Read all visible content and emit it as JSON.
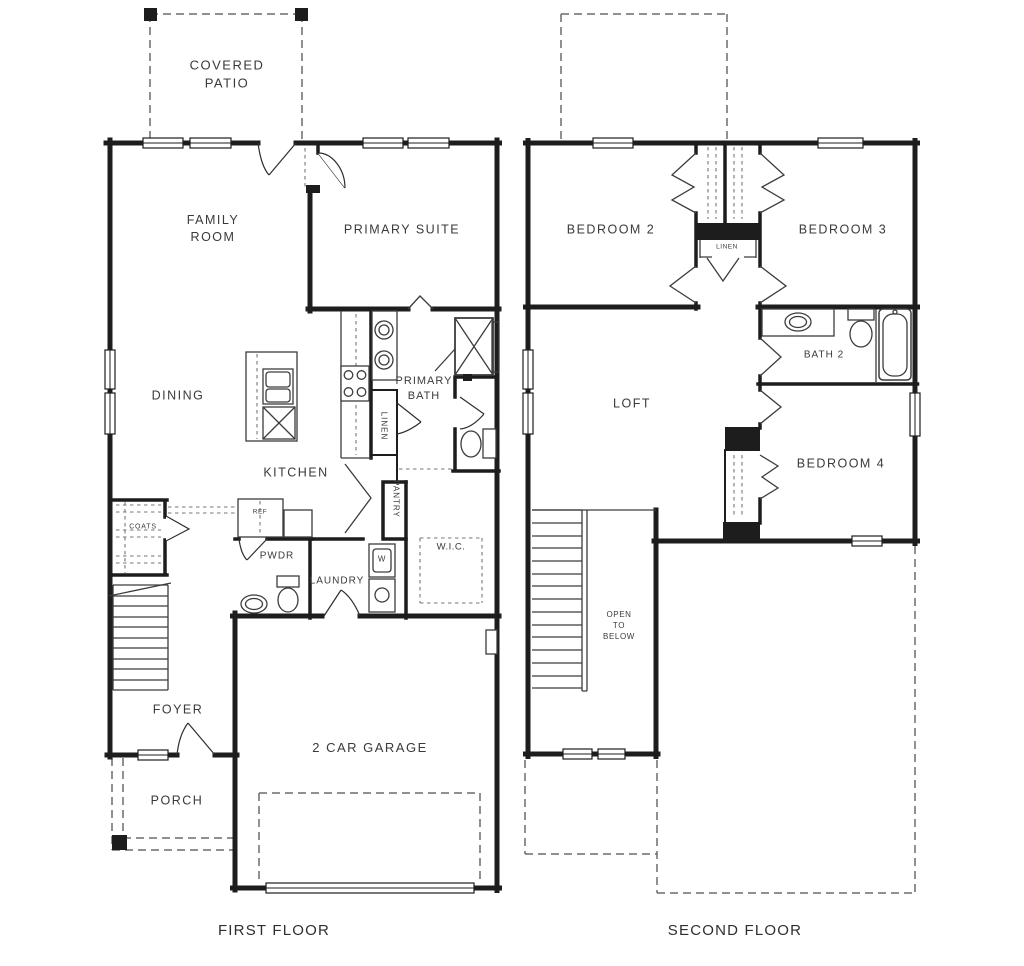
{
  "colors": {
    "background": "#ffffff",
    "walls": "#1d1d1d",
    "fixtures": "#3c3c3c",
    "dashed_lines": "#6b6b6b",
    "labels": "#3a3a3a"
  },
  "first_floor": {
    "caption": "FIRST FLOOR",
    "rooms": {
      "covered_patio_line1": "COVERED",
      "covered_patio_line2": "PATIO",
      "family_line1": "FAMILY",
      "family_line2": "ROOM",
      "primary_suite": "PRIMARY SUITE",
      "dining": "DINING",
      "kitchen": "KITCHEN",
      "primary_bath_line1": "PRIMARY",
      "primary_bath_line2": "BATH",
      "linen": "LINEN",
      "pantry": "PANTRY",
      "wic": "W.I.C.",
      "ref": "REF",
      "pwdr": "PWDR",
      "laundry": "LAUNDRY",
      "washer": "W",
      "coats": "COATS",
      "foyer": "FOYER",
      "porch": "PORCH",
      "garage": "2 CAR GARAGE"
    }
  },
  "second_floor": {
    "caption": "SECOND FLOOR",
    "rooms": {
      "bedroom2": "BEDROOM 2",
      "bedroom3": "BEDROOM 3",
      "linen": "LINEN",
      "bath2": "BATH 2",
      "loft": "LOFT",
      "bedroom4": "BEDROOM 4",
      "open_line1": "OPEN",
      "open_line2": "TO",
      "open_line3": "BELOW"
    }
  }
}
